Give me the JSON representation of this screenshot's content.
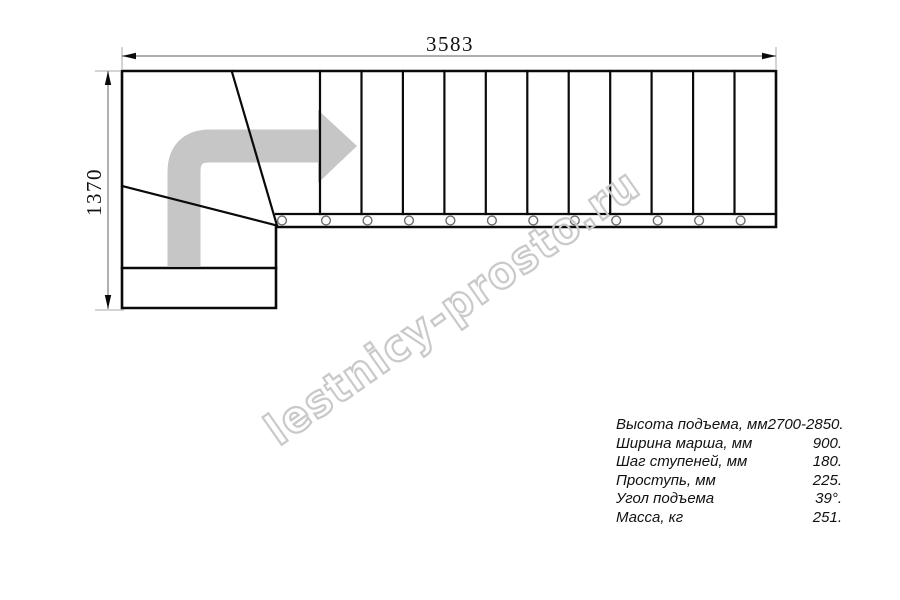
{
  "drawing": {
    "dim_width": "3583",
    "dim_height": "1370",
    "watermark": "lestnicy-prosto.ru",
    "colors": {
      "line": "#0a0a0a",
      "dim_line": "#7d7d7d",
      "ext_line": "#a8a8a8",
      "arrow_gray": "#c6c6c6",
      "watermark_gray": "#c9c9c9",
      "baluster": "#6e6e6e"
    }
  },
  "specs": {
    "rows": [
      {
        "label": "Высота подъема, мм",
        "value": "2700-2850."
      },
      {
        "label": "Ширина марша, мм",
        "value": "900."
      },
      {
        "label": "Шаг ступеней, мм",
        "value": "180."
      },
      {
        "label": "Проступь, мм",
        "value": "225."
      },
      {
        "label": "Угол подъема",
        "value": "39°."
      },
      {
        "label": "Масса, кг",
        "value": "251."
      }
    ]
  }
}
